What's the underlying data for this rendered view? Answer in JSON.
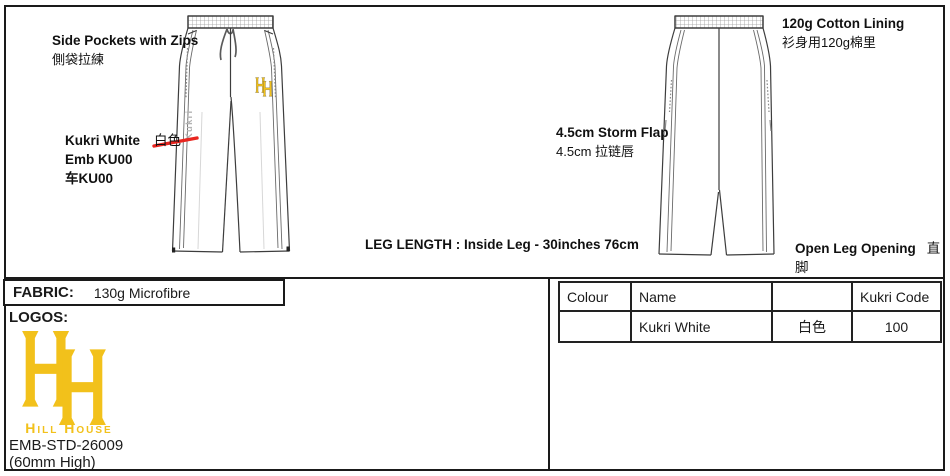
{
  "colors": {
    "gold": "#F2C11B",
    "red": "#E8251F",
    "outline": "#3d3d3d",
    "faint_text": "#b3b3b3"
  },
  "annotations": {
    "side_pockets": {
      "en": "Side Pockets with Zips",
      "zh": "側袋拉練"
    },
    "embroidery_colour": {
      "name_en": "Kukri White",
      "name_zh": "白色",
      "line2": "Emb KU00",
      "line3": "车KU00"
    },
    "lining": {
      "en": "120g Cotton Lining",
      "zh": "衫身用120g棉里"
    },
    "storm_flap": {
      "en": "4.5cm Storm Flap",
      "zh": "4.5cm 拉链唇"
    },
    "leg_length": "LEG LENGTH : Inside Leg - 30inches 76cm",
    "leg_opening": {
      "en": "Open Leg Opening",
      "zh": "直脚"
    }
  },
  "garment": {
    "side_seam_logo_text": "Kukri",
    "monogram_letters": "HH"
  },
  "fabric": {
    "label": "FABRIC:",
    "value": "130g Microfibre"
  },
  "logos": {
    "label": "LOGOS:",
    "brand_name": "Hill House",
    "embroidery_code": "EMB-STD-26009",
    "size_note": "(60mm High)"
  },
  "colour_table": {
    "headers": {
      "colour": "Colour",
      "name": "Name",
      "name_zh": "",
      "code": "Kukri Code"
    },
    "row": {
      "swatch": "",
      "name": "Kukri White",
      "name_zh": "白色",
      "code": "100"
    }
  }
}
